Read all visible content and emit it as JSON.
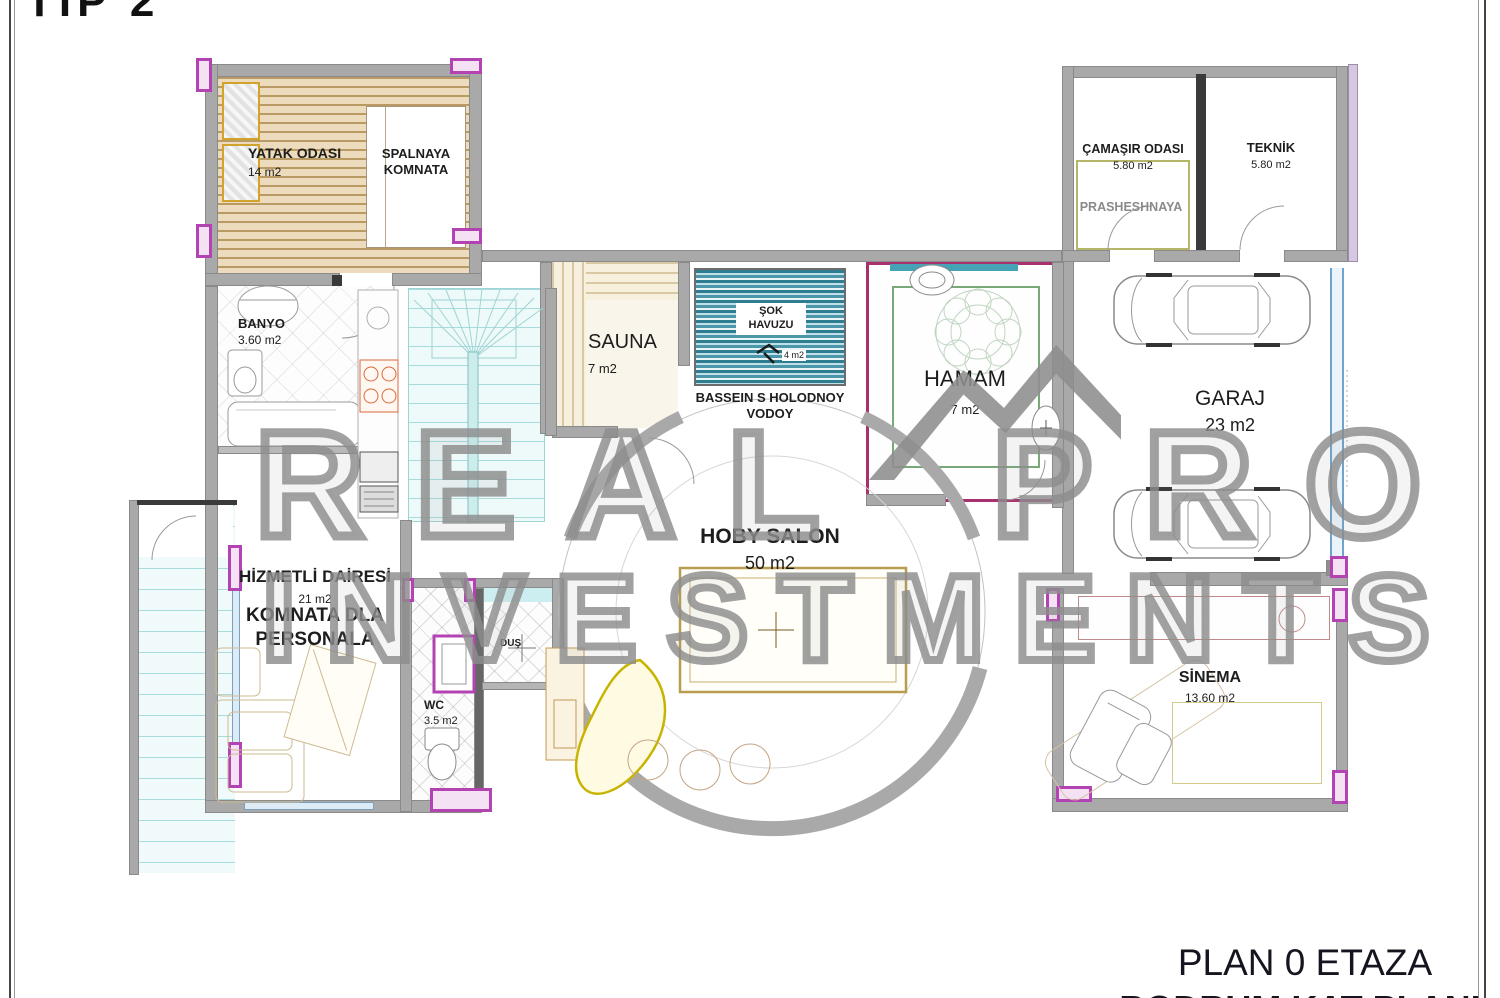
{
  "page": {
    "corner_label": "TİP 2",
    "plan_title": "PLAN 0 ETAZA",
    "plan_subtitle": "BODRUM KAT PLANI"
  },
  "watermark": {
    "line1": "REAL PRO",
    "line2": "INVESTMENTS"
  },
  "rooms": {
    "bedroom": {
      "name": "YATAK ODASI",
      "area": "14 m2",
      "alt_line1": "SPALNAYA",
      "alt_line2": "KOMNATA"
    },
    "banyo": {
      "name": "BANYO",
      "area": "3.60 m2"
    },
    "sauna": {
      "name": "SAUNA",
      "area": "7 m2"
    },
    "pool": {
      "name_line1": "ŞOK",
      "name_line2": "HAVUZU",
      "area": "4 m2",
      "alt_line1": "BASSEIN S HOLODNOY",
      "alt_line2": "VODOY"
    },
    "hamam": {
      "name": "HAMAM",
      "area": "7 m2"
    },
    "laundry": {
      "name": "ÇAMAŞIR ODASI",
      "area": "5.80 m2",
      "alt": "PRASHESHNAYA"
    },
    "teknik": {
      "name": "TEKNİK",
      "area": "5.80 m2"
    },
    "garaj": {
      "name": "GARAJ",
      "area": "23 m2"
    },
    "hoby": {
      "name": "HOBY SALON",
      "area": "50 m2"
    },
    "staff": {
      "name": "HİZMETLİ DAİRESİ",
      "area": "21 m2",
      "alt_line1": "KOMNATA DLA",
      "alt_line2": "PERSONALA"
    },
    "wc": {
      "name": "WC",
      "area": "3.5 m2"
    },
    "dus": {
      "name": "DUŞ"
    },
    "sinema": {
      "name": "SİNEMA",
      "area": "13.60 m2"
    }
  },
  "colors": {
    "wall": "#a9a9a9",
    "accent_magenta": "#b343b3",
    "hamam_border": "#a8306e",
    "pool_teal": "#2e7d91",
    "stair_cyan": "#9fd8d8",
    "wood": "#c9a96a",
    "watermark_gray": "#8c8c8c"
  }
}
